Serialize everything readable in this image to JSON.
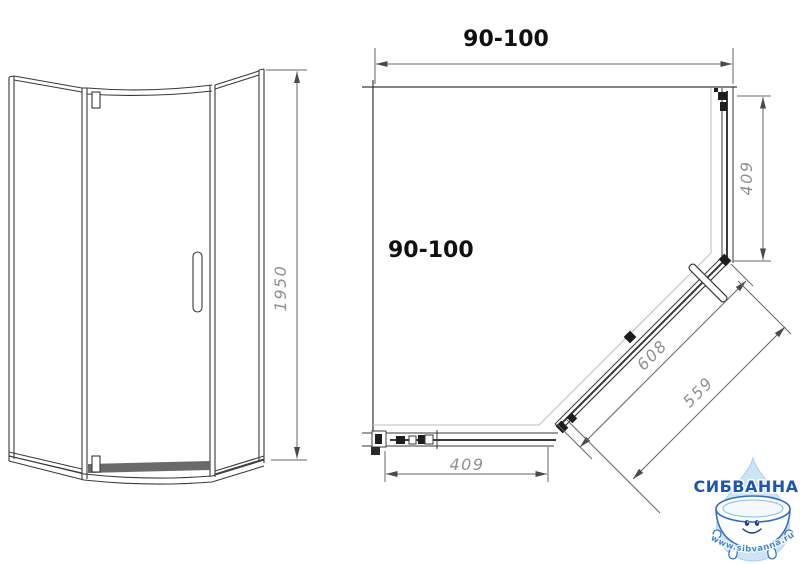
{
  "front_view": {
    "height": "1950"
  },
  "plan": {
    "width": "90-100",
    "depth": "90-100",
    "right_side": "409",
    "bottom_side": "409",
    "door_outer": "608",
    "door_glass": "559"
  },
  "logo": {
    "brand": "СИБВАННА",
    "website": "www.sibvanna.ru"
  },
  "colors": {
    "drawing_line": "#3a3a3a",
    "dimension_line": "#666666",
    "dimension_text": "#909090",
    "label_text": "#101010",
    "brand_blue": "#1a57b0",
    "logo_outline_blue": "#2e6fc0",
    "drop_blue": "#cde4f6",
    "background": "#ffffff"
  }
}
